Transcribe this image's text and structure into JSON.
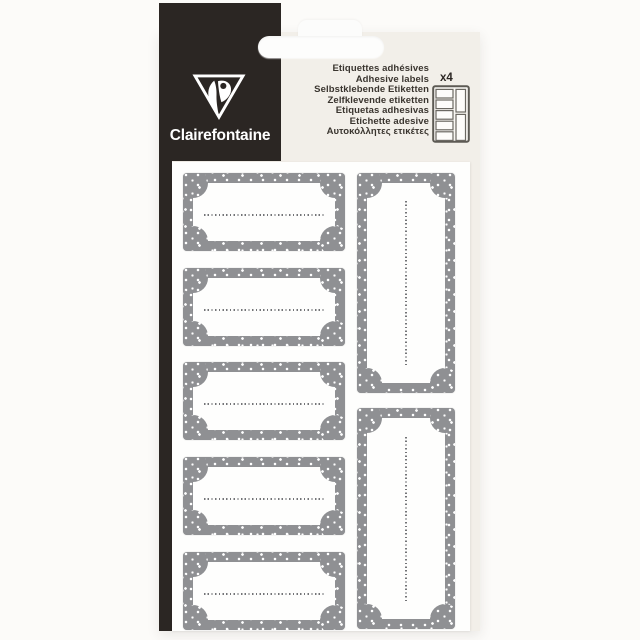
{
  "page": {
    "background_color": "#fcfbf9"
  },
  "package": {
    "brand": "Clairefontaine",
    "panel_color": "#2b2623",
    "card_color": "#f2efe9",
    "sheet_color": "#fefefd",
    "header": {
      "lines": [
        "Etiquettes adhésives",
        "Adhesive labels",
        "Selbstklebende Etiketten",
        "Zelfklevende etiketten",
        "Etiquetas adhesivas",
        "Etichette adesive",
        "Αυτοκόλλητες ετικέτες"
      ],
      "count_badge": "x4",
      "text_color": "#3a352f"
    },
    "icons": {
      "logo": "clairefontaine-triangle-profile-logo",
      "diagram": "label-sheet-schematic (5 small + 2 tall labels)"
    },
    "sheet": {
      "label_border_color": "#8f9093",
      "label_dot_color": "#ffffff",
      "writing_line_color": "#737477",
      "horizontal_labels_count": 5,
      "vertical_labels_count": 2
    }
  }
}
